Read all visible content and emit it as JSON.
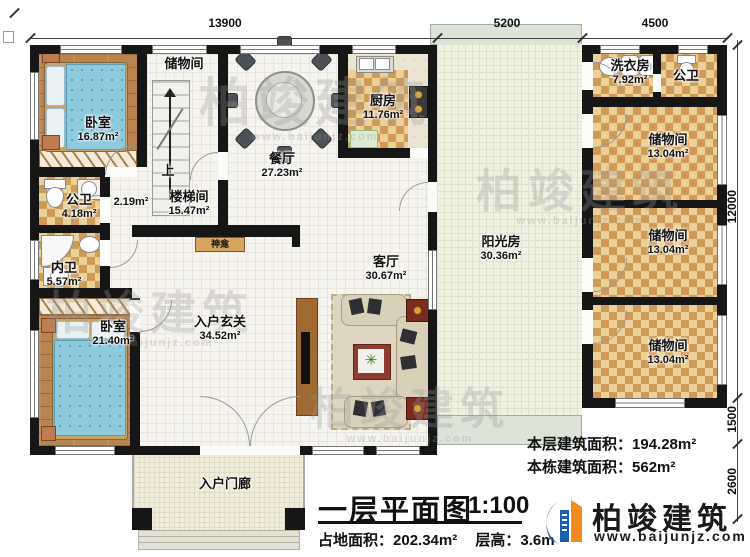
{
  "rooms": {
    "bedroom_top": {
      "label": "卧室",
      "area": "16.87m²"
    },
    "storage_stair": {
      "label": "储物间"
    },
    "stairwell": {
      "label": "楼梯间",
      "area": "15.47m²"
    },
    "closet_area": {
      "area": "2.19m²"
    },
    "bath_public_left": {
      "label": "公卫",
      "area": "4.18m²"
    },
    "bath_private": {
      "label": "内卫",
      "area": "5.57m²"
    },
    "bedroom_bottom": {
      "label": "卧室",
      "area": "21.40m²"
    },
    "dining": {
      "label": "餐厅",
      "area": "27.23m²"
    },
    "kitchen": {
      "label": "厨房",
      "area": "11.76m²"
    },
    "living": {
      "label": "客厅",
      "area": "30.67m²"
    },
    "foyer": {
      "label": "入户玄关",
      "area": "34.52m²"
    },
    "shrine": {
      "label": "神龛"
    },
    "sunroom": {
      "label": "阳光房",
      "area": "30.36m²"
    },
    "laundry": {
      "label": "洗衣房",
      "area": "7.92m²"
    },
    "bath_public_right": {
      "label": "公卫"
    },
    "storage_1": {
      "label": "储物间",
      "area": "13.04m²"
    },
    "storage_2": {
      "label": "储物间",
      "area": "13.04m²"
    },
    "storage_3": {
      "label": "储物间",
      "area": "13.04m²"
    },
    "porch": {
      "label": "入户门廊"
    }
  },
  "stairs": {
    "up_label": "上"
  },
  "dims": {
    "top": [
      "13900",
      "5200",
      "4500"
    ],
    "right": [
      "12000",
      "1500",
      "2600"
    ]
  },
  "title_block": {
    "title": "一层平面图",
    "scale": "1:100",
    "footprint_label": "占地面积：",
    "footprint_value": "202.34m²",
    "height_label": "层高：",
    "height_value": "3.6m",
    "floor_area_label": "本层建筑面积：",
    "floor_area_value": "194.28m²",
    "building_area_label": "本栋建筑面积：",
    "building_area_value": "562m²"
  },
  "brand": {
    "name": "柏竣建筑",
    "website": "www.baijunjz.com"
  },
  "watermark": {
    "text": "柏竣建筑",
    "sub": "www.baijunjz.com"
  },
  "colors": {
    "wall": "#161616",
    "wood_floor": "#b9854e",
    "checker_dark": "#cf9a55",
    "checker_light": "#ecd09a",
    "sunroom_floor": "#f0f1e1",
    "bed_blue": "#8ecadd",
    "accent_blue": "#1c5fae",
    "accent_orange": "#f28a1e",
    "shrine_box": "#d7a45f"
  }
}
